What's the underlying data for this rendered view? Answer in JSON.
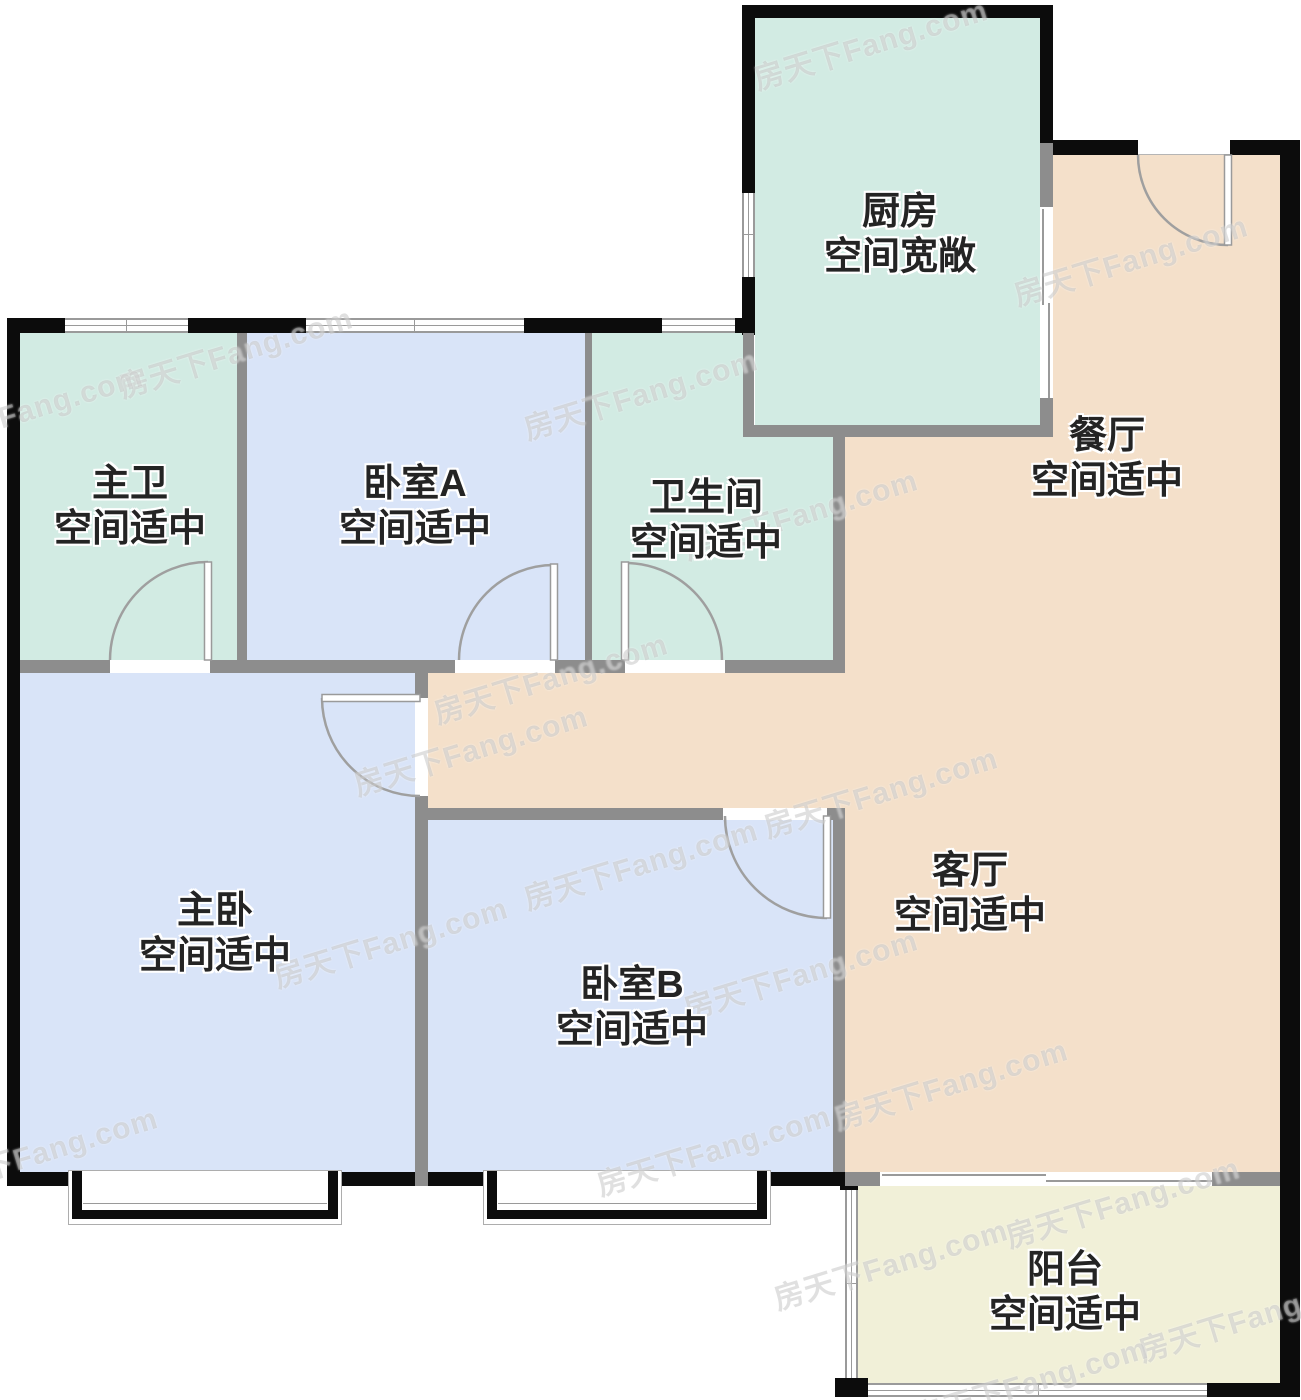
{
  "watermark": {
    "text": "房天下Fang.com"
  },
  "colors": {
    "wall": "#0c0c0c",
    "part": "#8d8d8d",
    "mint": "#d2ebe3",
    "blue": "#d9e4f8",
    "peach": "#f4e0ca",
    "balc": "#f1f0d8",
    "label": "#242424",
    "frame": "#9a9a9a",
    "wm": "rgba(178,178,178,0.40)"
  },
  "rooms": [
    {
      "id": "kitchen",
      "name": "厨房",
      "desc": "空间宽敞"
    },
    {
      "id": "dining",
      "name": "餐厅",
      "desc": "空间适中"
    },
    {
      "id": "master-bath",
      "name": "主卫",
      "desc": "空间适中"
    },
    {
      "id": "bedroom-a",
      "name": "卧室A",
      "desc": "空间适中"
    },
    {
      "id": "bathroom",
      "name": "卫生间",
      "desc": "空间适中"
    },
    {
      "id": "master-bedroom",
      "name": "主卧",
      "desc": "空间适中"
    },
    {
      "id": "bedroom-b",
      "name": "卧室B",
      "desc": "空间适中"
    },
    {
      "id": "living",
      "name": "客厅",
      "desc": "空间适中"
    },
    {
      "id": "balcony",
      "name": "阳台",
      "desc": "空间适中"
    }
  ]
}
